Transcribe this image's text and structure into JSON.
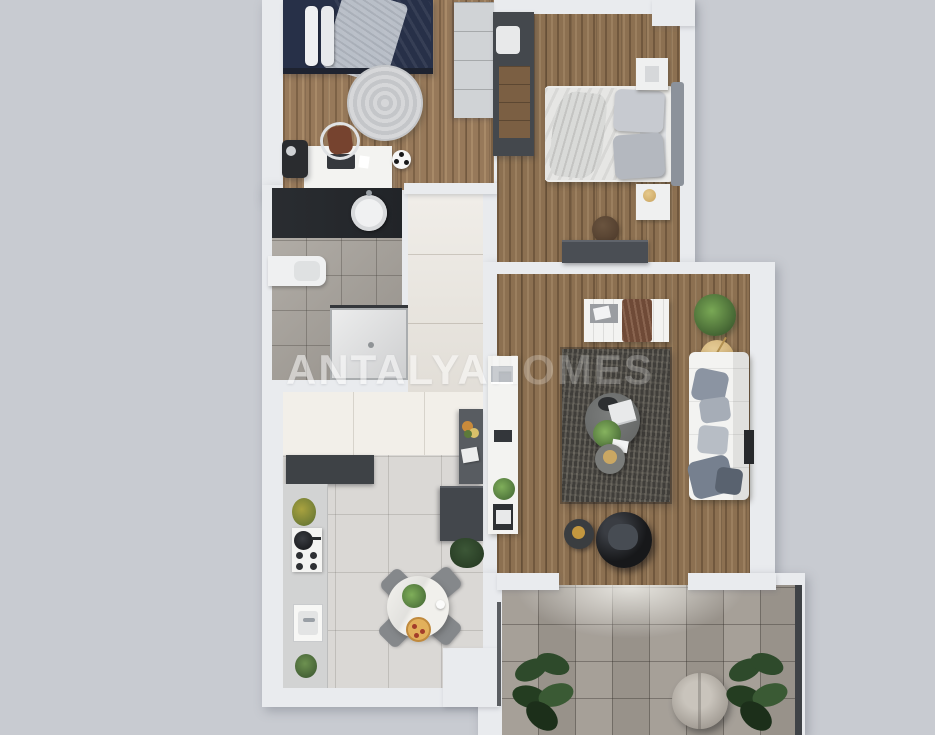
{
  "image": {
    "type": "3d-rendered-apartment-floor-plan-top-view",
    "width": 935,
    "height": 735
  },
  "watermark": {
    "part1": "ANTALYA",
    "part2": "HOMES"
  },
  "palette": {
    "bg": "#c8cbd1",
    "wall": "#e9ebee",
    "wood": "#97795a",
    "wood2": "#8c7051",
    "hallTile": "#ebe7e0",
    "entryTile": "#f2efe9",
    "kitchenTile": "#dad8d5",
    "bathTile": "#a6a19a",
    "terraceTile": "#a19b93",
    "vanity": "#212428",
    "navy": "#43506c",
    "rug": "#403e3a",
    "white": "#f3f3f1",
    "sofaPillow": "#8b94a2",
    "gold": "#cfae74",
    "greenDark": "#2e4a2b",
    "brown": "#6f4a37",
    "egg": "#17181a"
  },
  "rooms": [
    {
      "name": "bedroom-1",
      "furniture": [
        "single-bed-navy-bedding",
        "wardrobe",
        "round-rug",
        "desk",
        "desk-chair",
        "laptop",
        "camera-bag",
        "soccer-ball"
      ]
    },
    {
      "name": "bedroom-2",
      "furniture": [
        "double-bed-white-bedding",
        "open-wardrobe",
        "nightstand-top",
        "nightstand-lamp",
        "dresser",
        "pouf"
      ]
    },
    {
      "name": "bathroom",
      "furniture": [
        "dark-vanity",
        "round-sink",
        "toilet",
        "shower"
      ]
    },
    {
      "name": "hallway",
      "furniture": [
        "console-sideboard",
        "flowers",
        "papers"
      ]
    },
    {
      "name": "kitchen",
      "furniture": [
        "dark-counter",
        "counter",
        "stove",
        "pan",
        "sink",
        "plants",
        "round-dining-table",
        "four-chairs",
        "pizza",
        "table-plant"
      ]
    },
    {
      "name": "living-room",
      "furniture": [
        "tv-console",
        "bench-daybed",
        "brown-throw",
        "potted-plant",
        "gold-side-table",
        "sofa",
        "pillows",
        "wall-tv",
        "area-rug",
        "round-coffee-table",
        "nesting-table",
        "black-swivel-chair",
        "side-table"
      ]
    },
    {
      "name": "terrace",
      "furniture": [
        "round-pouf",
        "potted-plant-left",
        "potted-plant-right"
      ]
    }
  ]
}
